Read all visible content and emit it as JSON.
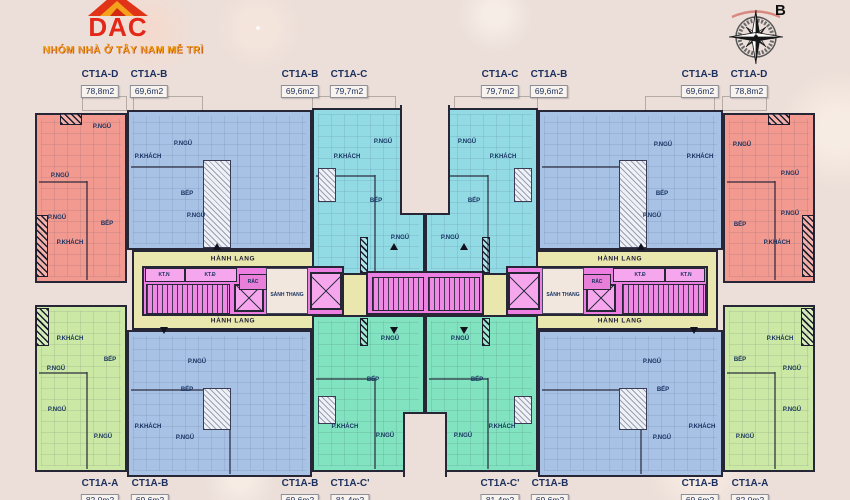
{
  "header": {
    "logo_text": "DAC",
    "slogan": "NHÓM NHÀ Ở TÂY NAM MỄ TRÌ",
    "compass_label": "B"
  },
  "colors": {
    "background": "#ecdfd9",
    "wall": "#262637",
    "label": "#1b2f5e",
    "unit_d": "#f29a90",
    "unit_b": "#a8c2e6",
    "unit_c": "#93dbe4",
    "unit_cp": "#82e3c0",
    "unit_a": "#cbe9a4",
    "core": "#ee7fe2",
    "corridor": "#e9e6ae"
  },
  "units": [
    {
      "id": "d1",
      "type": "CT1A-D"
    },
    {
      "id": "b1",
      "type": "CT1A-B"
    },
    {
      "id": "c1",
      "type": "CT1A-C"
    },
    {
      "id": "c2",
      "type": "CT1A-C"
    },
    {
      "id": "b2",
      "type": "CT1A-B"
    },
    {
      "id": "d2",
      "type": "CT1A-D"
    },
    {
      "id": "a1",
      "type": "CT1A-A"
    },
    {
      "id": "b3",
      "type": "CT1A-B"
    },
    {
      "id": "t1",
      "type": "CT1A-C'"
    },
    {
      "id": "t2",
      "type": "CT1A-C'"
    },
    {
      "id": "b4",
      "type": "CT1A-B"
    },
    {
      "id": "a2",
      "type": "CT1A-A"
    }
  ],
  "top_labels": [
    {
      "name": "CT1A-D",
      "area": "78,8m2",
      "x": 100
    },
    {
      "name": "CT1A-B",
      "area": "69,6m2",
      "x": 149
    },
    {
      "name": "CT1A-B",
      "area": "69,6m2",
      "x": 300
    },
    {
      "name": "CT1A-C",
      "area": "79,7m2",
      "x": 349
    },
    {
      "name": "CT1A-C",
      "area": "79,7m2",
      "x": 500
    },
    {
      "name": "CT1A-B",
      "area": "69,6m2",
      "x": 549
    },
    {
      "name": "CT1A-B",
      "area": "69,6m2",
      "x": 700
    },
    {
      "name": "CT1A-D",
      "area": "78,8m2",
      "x": 749
    }
  ],
  "bottom_labels": [
    {
      "name": "CT1A-A",
      "area": "82,0m2",
      "x": 100
    },
    {
      "name": "CT1A-B",
      "area": "69,6m2",
      "x": 150
    },
    {
      "name": "CT1A-B",
      "area": "69,6m2",
      "x": 300
    },
    {
      "name": "CT1A-C'",
      "area": "81,4m2",
      "x": 350
    },
    {
      "name": "CT1A-C'",
      "area": "81,4m2",
      "x": 500
    },
    {
      "name": "CT1A-B",
      "area": "69,6m2",
      "x": 550
    },
    {
      "name": "CT1A-B",
      "area": "69,6m2",
      "x": 700
    },
    {
      "name": "CT1A-A",
      "area": "82,0m2",
      "x": 750
    }
  ],
  "corridor_labels": [
    {
      "text": "HÀNH LANG",
      "x": 233,
      "y": 259
    },
    {
      "text": "HÀNH LANG",
      "x": 233,
      "y": 321
    },
    {
      "text": "HÀNH LANG",
      "x": 620,
      "y": 259
    },
    {
      "text": "HÀNH LANG",
      "x": 620,
      "y": 321
    }
  ],
  "core_labels": [
    {
      "text": "KT.N",
      "x": 164,
      "y": 275
    },
    {
      "text": "KT.Đ",
      "x": 210,
      "y": 275
    },
    {
      "text": "RÁC",
      "x": 253,
      "y": 282
    },
    {
      "text": "SẢNH THANG",
      "x": 287,
      "y": 295
    },
    {
      "text": "SẢNH THANG",
      "x": 563,
      "y": 295
    },
    {
      "text": "RÁC",
      "x": 597,
      "y": 282
    },
    {
      "text": "KT.Đ",
      "x": 640,
      "y": 275
    },
    {
      "text": "KT.N",
      "x": 686,
      "y": 275
    }
  ],
  "room_labels": [
    {
      "text": "P.NGỦ",
      "x": 102,
      "y": 127
    },
    {
      "text": "P.NGỦ",
      "x": 60,
      "y": 176
    },
    {
      "text": "P.NGỦ",
      "x": 57,
      "y": 218
    },
    {
      "text": "BẾP",
      "x": 107,
      "y": 224
    },
    {
      "text": "P.KHÁCH",
      "x": 70,
      "y": 243
    },
    {
      "text": "P.NGỦ",
      "x": 183,
      "y": 144
    },
    {
      "text": "P.KHÁCH",
      "x": 148,
      "y": 157
    },
    {
      "text": "BẾP",
      "x": 187,
      "y": 194
    },
    {
      "text": "P.NGỦ",
      "x": 196,
      "y": 216
    },
    {
      "text": "P.NGỦ",
      "x": 383,
      "y": 142
    },
    {
      "text": "P.KHÁCH",
      "x": 347,
      "y": 157
    },
    {
      "text": "BẾP",
      "x": 376,
      "y": 201
    },
    {
      "text": "P.NGỦ",
      "x": 400,
      "y": 238
    },
    {
      "text": "P.NGỦ",
      "x": 467,
      "y": 142
    },
    {
      "text": "P.KHÁCH",
      "x": 503,
      "y": 157
    },
    {
      "text": "BẾP",
      "x": 474,
      "y": 201
    },
    {
      "text": "P.NGỦ",
      "x": 450,
      "y": 238
    },
    {
      "text": "P.NGỦ",
      "x": 663,
      "y": 145
    },
    {
      "text": "P.KHÁCH",
      "x": 700,
      "y": 157
    },
    {
      "text": "BẾP",
      "x": 662,
      "y": 194
    },
    {
      "text": "P.NGỦ",
      "x": 652,
      "y": 216
    },
    {
      "text": "P.NGỦ",
      "x": 742,
      "y": 145
    },
    {
      "text": "P.NGỦ",
      "x": 790,
      "y": 174
    },
    {
      "text": "P.NGỦ",
      "x": 790,
      "y": 214
    },
    {
      "text": "BẾP",
      "x": 740,
      "y": 225
    },
    {
      "text": "P.KHÁCH",
      "x": 777,
      "y": 243
    },
    {
      "text": "P.KHÁCH",
      "x": 70,
      "y": 339
    },
    {
      "text": "P.NGỦ",
      "x": 56,
      "y": 369
    },
    {
      "text": "BẾP",
      "x": 110,
      "y": 360
    },
    {
      "text": "P.NGỦ",
      "x": 57,
      "y": 410
    },
    {
      "text": "P.NGỦ",
      "x": 103,
      "y": 437
    },
    {
      "text": "P.NGỦ",
      "x": 197,
      "y": 362
    },
    {
      "text": "BẾP",
      "x": 187,
      "y": 390
    },
    {
      "text": "P.KHÁCH",
      "x": 148,
      "y": 427
    },
    {
      "text": "P.NGỦ",
      "x": 185,
      "y": 438
    },
    {
      "text": "P.NGỦ",
      "x": 390,
      "y": 339
    },
    {
      "text": "BẾP",
      "x": 373,
      "y": 380
    },
    {
      "text": "P.KHÁCH",
      "x": 345,
      "y": 427
    },
    {
      "text": "P.NGỦ",
      "x": 385,
      "y": 436
    },
    {
      "text": "P.NGỦ",
      "x": 460,
      "y": 339
    },
    {
      "text": "BẾP",
      "x": 477,
      "y": 380
    },
    {
      "text": "P.KHÁCH",
      "x": 502,
      "y": 427
    },
    {
      "text": "P.NGỦ",
      "x": 463,
      "y": 436
    },
    {
      "text": "P.NGỦ",
      "x": 652,
      "y": 362
    },
    {
      "text": "BẾP",
      "x": 663,
      "y": 390
    },
    {
      "text": "P.KHÁCH",
      "x": 702,
      "y": 427
    },
    {
      "text": "P.NGỦ",
      "x": 662,
      "y": 438
    },
    {
      "text": "P.KHÁCH",
      "x": 780,
      "y": 339
    },
    {
      "text": "P.NGỦ",
      "x": 792,
      "y": 369
    },
    {
      "text": "BẾP",
      "x": 740,
      "y": 360
    },
    {
      "text": "P.NGỦ",
      "x": 792,
      "y": 410
    },
    {
      "text": "P.NGỦ",
      "x": 745,
      "y": 437
    }
  ]
}
